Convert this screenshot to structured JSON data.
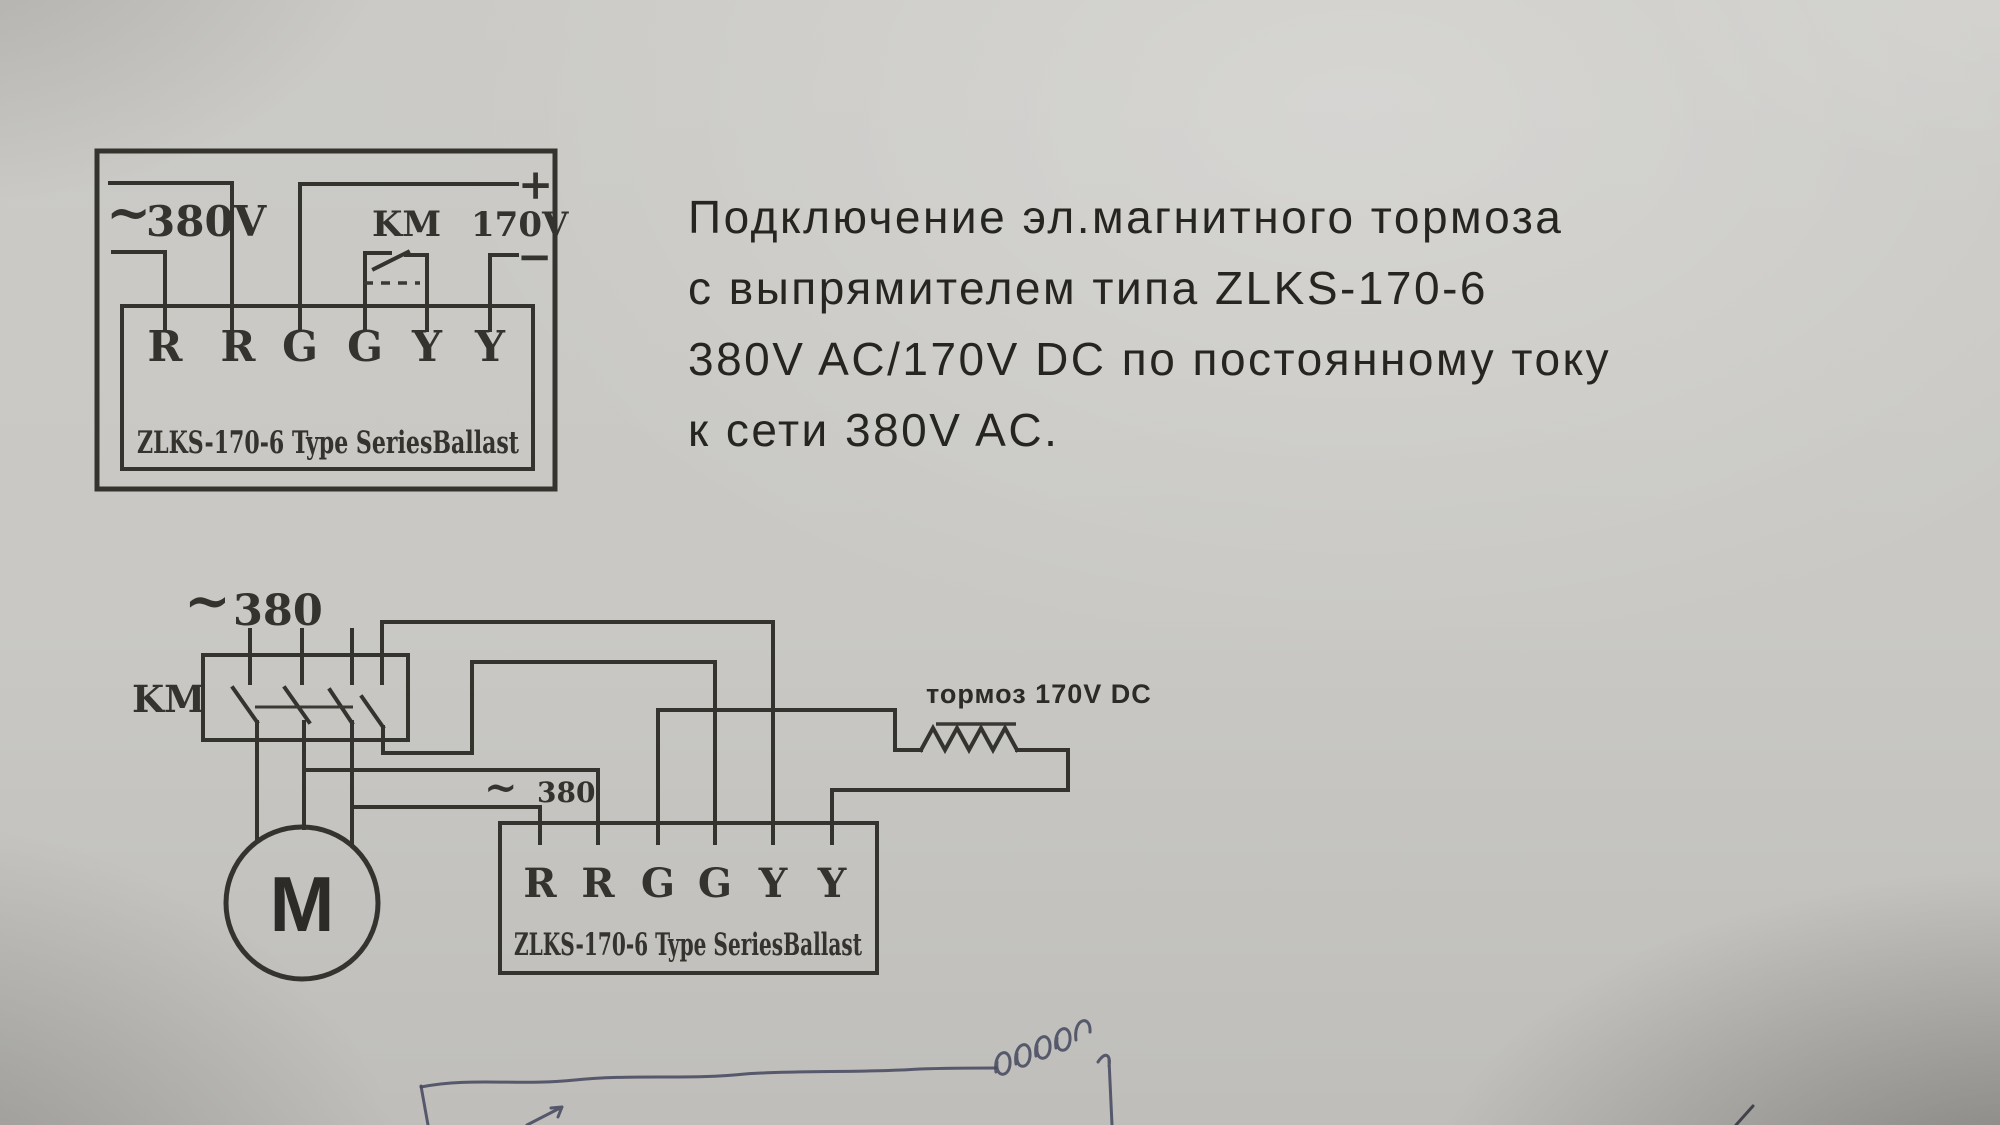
{
  "colors": {
    "paper": "#c8c7c3",
    "ink": "#34332e",
    "pen_ink": "#474a60",
    "text": "#26251f"
  },
  "description": {
    "lines": [
      "Подключение эл.магнитного тормоза",
      "с выпрямителем типа ZLKS-170-6",
      "380V AC/170V DC по постоянному току",
      "к сети 380V AC."
    ]
  },
  "top_diagram": {
    "ac_symbol": "~",
    "ac_supply_label": "380V",
    "contactor_label": "KM",
    "dc_voltage_label": "170V",
    "plus_label": "+",
    "minus_label": "−",
    "terminals": [
      "R",
      "R",
      "G",
      "G",
      "Y",
      "Y"
    ],
    "device_label": "ZLKS-170-6 Type SeriesBallast"
  },
  "bottom_diagram": {
    "ac_symbol": "~",
    "ac_supply_label": "380",
    "contactor_label": "KM",
    "motor_label": "M",
    "brake_label": "тормоз 170V DC",
    "ac_input_symbol": "~",
    "ac_input_label": "380",
    "terminals": [
      "R",
      "R",
      "G",
      "G",
      "Y",
      "Y"
    ],
    "device_label": "ZLKS-170-6 Type SeriesBallast"
  }
}
